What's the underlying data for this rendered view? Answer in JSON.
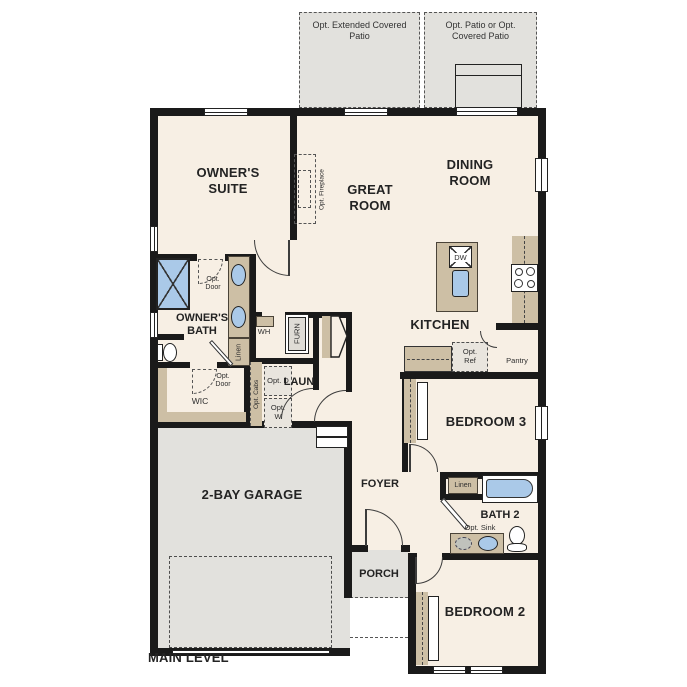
{
  "title": "MAIN LEVEL",
  "patios": {
    "left": "Opt. Extended Covered Patio",
    "right": "Opt. Patio or Opt. Covered Patio"
  },
  "rooms": {
    "owners_suite": "OWNER'S SUITE",
    "great_room": "GREAT ROOM",
    "dining_room": "DINING ROOM",
    "kitchen": "KITCHEN",
    "owners_bath": "OWNER'S BATH",
    "wic": "WIC",
    "laundry": "LAUN",
    "foyer": "FOYER",
    "porch": "PORCH",
    "garage": "2-BAY GARAGE",
    "bedroom3": "BEDROOM 3",
    "bath2": "BATH 2",
    "bedroom2": "BEDROOM 2"
  },
  "labels": {
    "opt_fireplace": "Opt. Fireplace",
    "opt_door": "Opt. Door",
    "opt_ref": "Opt. Ref",
    "pantry": "Pantry",
    "linen": "Linen",
    "wh": "WH",
    "furn": "FURN",
    "opt_cabs": "Opt. Cabs",
    "opt_d": "Opt. D",
    "opt_w": "Opt. W",
    "opt_sink": "Opt. Sink",
    "dw": "DW"
  },
  "colors": {
    "floor": "#f7efe4",
    "concrete": "#e2e1dd",
    "tan": "#cdbfa5",
    "blue": "#aac9e8",
    "wall": "#1a1a1a"
  }
}
